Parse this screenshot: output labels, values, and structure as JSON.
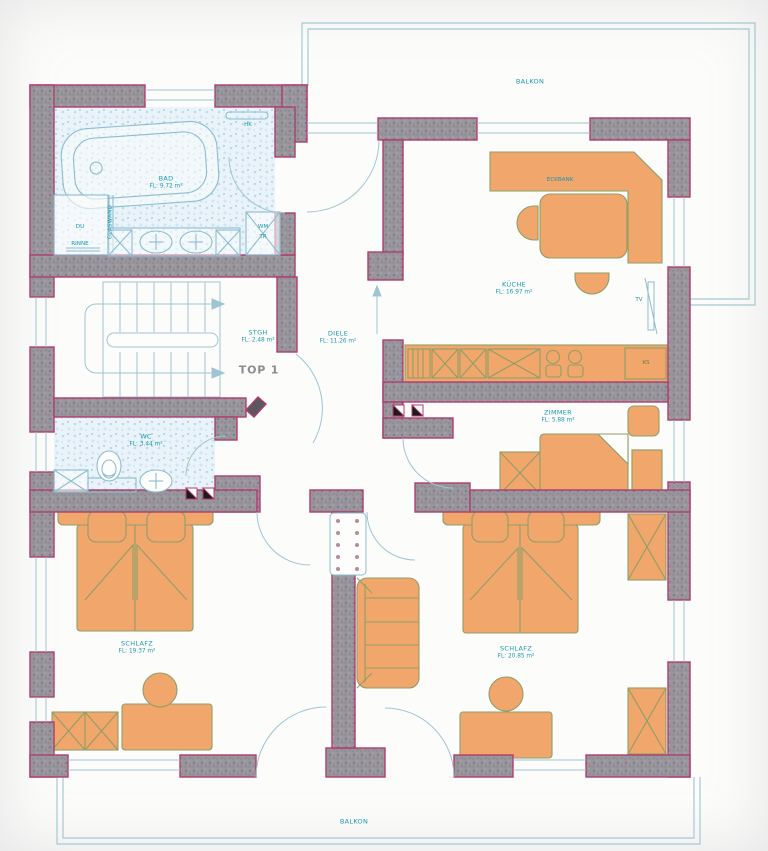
{
  "plan": {
    "balcony_top": "BALKON",
    "balcony_bottom": "BALKON",
    "unit": "TOP 1",
    "rooms": {
      "bad": {
        "name": "BAD",
        "area": "FL: 9.72 m²"
      },
      "stgh": {
        "name": "STGH",
        "area": "FL: 2.48 m²"
      },
      "diele": {
        "name": "DIELE",
        "area": "FL: 11.26 m²"
      },
      "kueche": {
        "name": "KÜCHE",
        "area": "FL: 16.97 m²"
      },
      "wc": {
        "name": "WC",
        "area": "FL: 3.44 m²"
      },
      "zimmer": {
        "name": "ZIMMER",
        "area": "FL: 5.88 m²"
      },
      "schlafz_left": {
        "name": "SCHLAFZ",
        "area": "FL: 19.37 m²"
      },
      "schlafz_right": {
        "name": "SCHLAFZ",
        "area": "FL: 20.85 m²"
      }
    },
    "annotations": {
      "hk": "HK",
      "du": "DU",
      "rinne": "RINNE",
      "glaswand": "GLASWAND",
      "wm": "WM",
      "tr": "TR",
      "eckbank": "ECKBANK",
      "tv": "TV",
      "ks": "KS"
    },
    "colors": {
      "wall_outline": "#b13d6e",
      "wall_fill": "#98959c",
      "line_blue": "#9fc4d2",
      "furniture_fill": "#f1a66b",
      "furniture_outline": "#8f9e68",
      "label_text": "#1b97ae"
    }
  }
}
